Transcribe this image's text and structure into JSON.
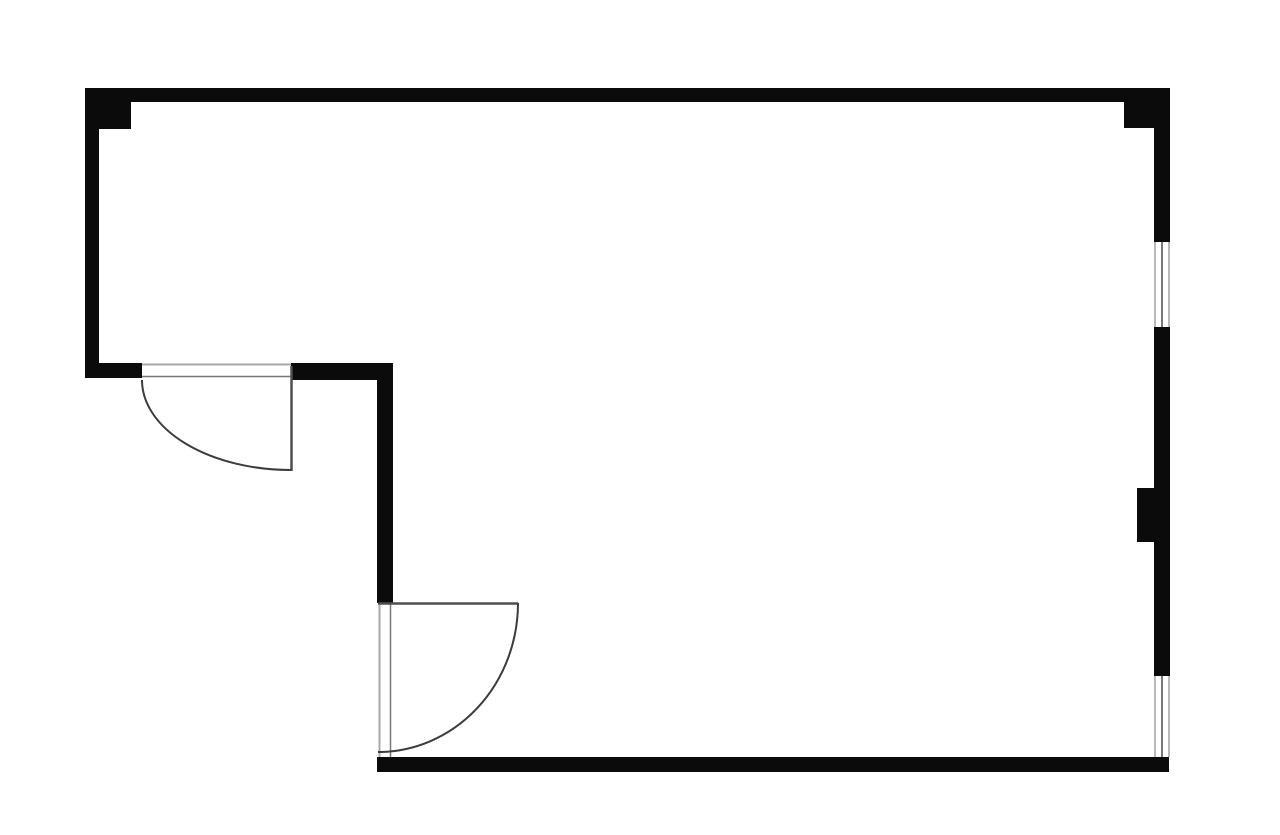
{
  "canvas": {
    "width": 1280,
    "height": 835,
    "background": "#ffffff"
  },
  "colors": {
    "wall": "#0b0b0b",
    "door_leaf": "#4f4f4f",
    "door_arc": "#3c3c3c",
    "opening_edge_light": "#a8a8a8",
    "opening_edge_dark": "#767676",
    "window_edge": "#a0a0a0",
    "window_glass": "#575757",
    "floor": "#ffffff"
  },
  "walls": [
    {
      "name": "top-wall",
      "x": 85,
      "y": 88,
      "w": 1085,
      "h": 14
    },
    {
      "name": "corner-block-top-left",
      "x": 85,
      "y": 88,
      "w": 46,
      "h": 41
    },
    {
      "name": "corner-block-top-right",
      "x": 1124,
      "y": 88,
      "w": 46,
      "h": 40
    },
    {
      "name": "left-wall",
      "x": 85,
      "y": 88,
      "w": 14,
      "h": 290
    },
    {
      "name": "left-door-jamb-wall",
      "x": 85,
      "y": 363,
      "w": 57,
      "h": 15
    },
    {
      "name": "step-wall",
      "x": 291,
      "y": 363,
      "w": 102,
      "h": 17
    },
    {
      "name": "interior-vertical-wall",
      "x": 377,
      "y": 363,
      "w": 16,
      "h": 240
    },
    {
      "name": "right-wall-upper",
      "x": 1154,
      "y": 88,
      "w": 16,
      "h": 154
    },
    {
      "name": "right-wall-mid",
      "x": 1154,
      "y": 327,
      "w": 16,
      "h": 161
    },
    {
      "name": "right-wall-pier",
      "x": 1137,
      "y": 488,
      "w": 33,
      "h": 54
    },
    {
      "name": "right-wall-lower",
      "x": 1154,
      "y": 542,
      "w": 16,
      "h": 134
    },
    {
      "name": "bottom-wall",
      "x": 377,
      "y": 757,
      "w": 792,
      "h": 15
    }
  ],
  "windows": [
    {
      "name": "window-right-upper",
      "x1": 1154,
      "x2": 1170,
      "y1": 242,
      "y2": 327
    },
    {
      "name": "window-right-lower",
      "x1": 1154,
      "x2": 1170,
      "y1": 676,
      "y2": 757
    }
  ],
  "doors": [
    {
      "name": "door-left",
      "opening_lines": [
        {
          "x1": 142,
          "y1": 364.5,
          "x2": 291,
          "y2": 364.5,
          "width": 2,
          "tone": "light"
        },
        {
          "x1": 142,
          "y1": 376.5,
          "x2": 291,
          "y2": 376.5,
          "width": 1.5,
          "tone": "dark"
        }
      ],
      "leaf": {
        "x1": 291.5,
        "y1": 366,
        "x2": 291.5,
        "y2": 471,
        "width": 2.5
      },
      "arc": {
        "path": "M 142 380 A 149 90 0 0 0 291 470",
        "width": 2
      }
    },
    {
      "name": "door-bottom",
      "opening_lines": [
        {
          "x1": 379.5,
          "y1": 603,
          "x2": 379.5,
          "y2": 757,
          "width": 2,
          "tone": "light"
        },
        {
          "x1": 390.5,
          "y1": 603,
          "x2": 390.5,
          "y2": 757,
          "width": 1.5,
          "tone": "dark"
        }
      ],
      "leaf": {
        "x1": 378,
        "y1": 603.5,
        "x2": 518,
        "y2": 603.5,
        "width": 2.5
      },
      "arc": {
        "path": "M 518 603 A 140 149 0 0 1 378 752",
        "width": 2
      }
    }
  ]
}
